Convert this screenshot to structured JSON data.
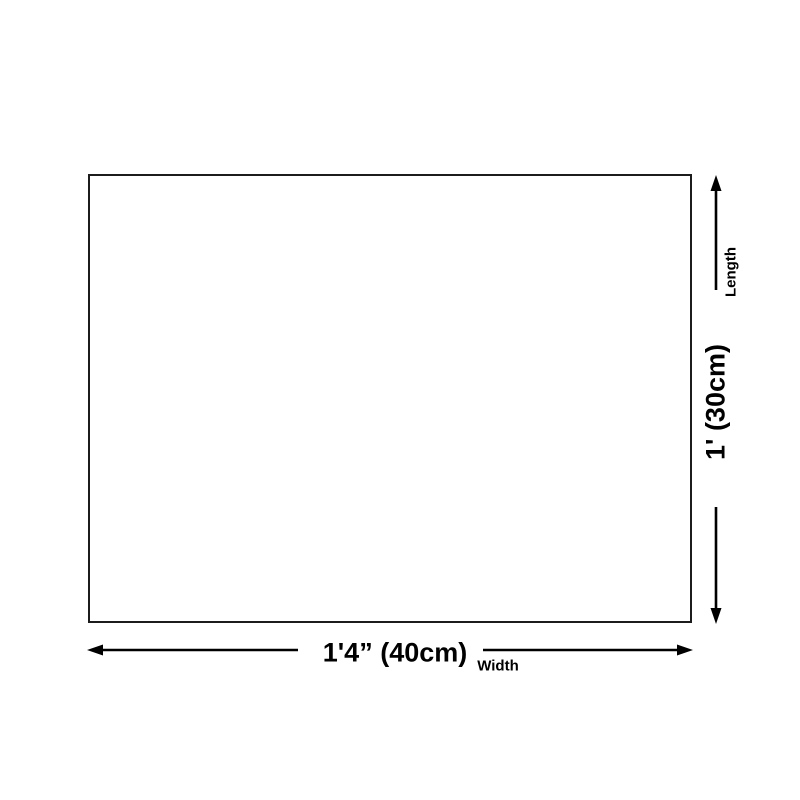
{
  "diagram": {
    "type": "product-dimension-diagram",
    "width_dimension": {
      "value_label": "1'4” (40cm)",
      "axis_label": "Width"
    },
    "length_dimension": {
      "value_label": "1' (30cm)",
      "axis_label": "Length"
    },
    "colors": {
      "background": "#ffffff",
      "box_border": "#1c1c1c",
      "arrow": "#000000",
      "text": "#000000"
    }
  }
}
